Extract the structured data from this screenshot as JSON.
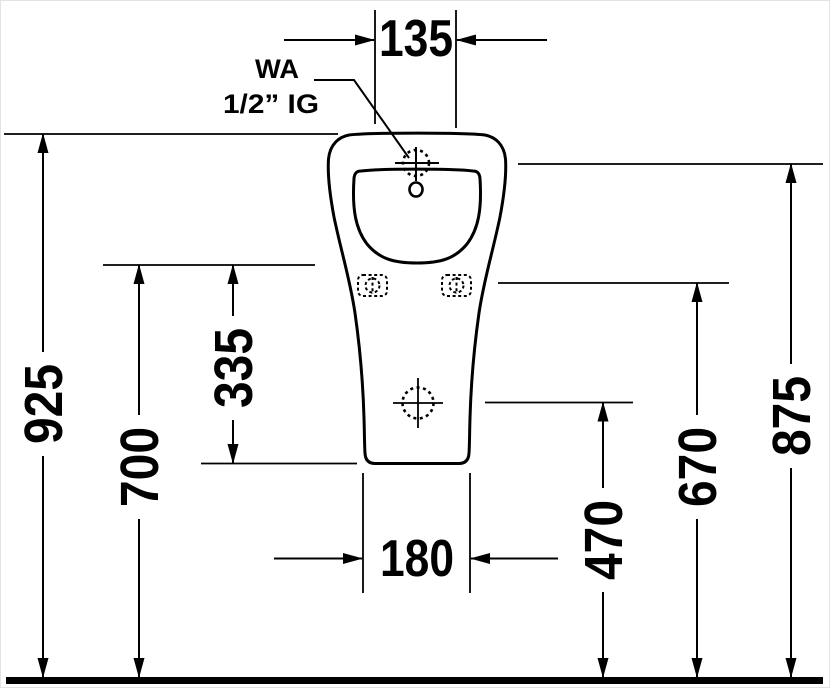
{
  "drawing": {
    "kind": "sanitary-ware dimension drawing, urinal front view",
    "unit_system": "mm",
    "line_color": "#000000",
    "background_color": "#ffffff",
    "dimensions": {
      "top_width": "135",
      "overall_height": "925",
      "rim_height": "700",
      "rim_to_base": "335",
      "base_width": "180",
      "outlet_height": "470",
      "fixing_height": "670",
      "inlet_height": "875"
    },
    "annotations": {
      "water_connection_line1": "WA",
      "water_connection_line2": "1/2” IG"
    }
  }
}
